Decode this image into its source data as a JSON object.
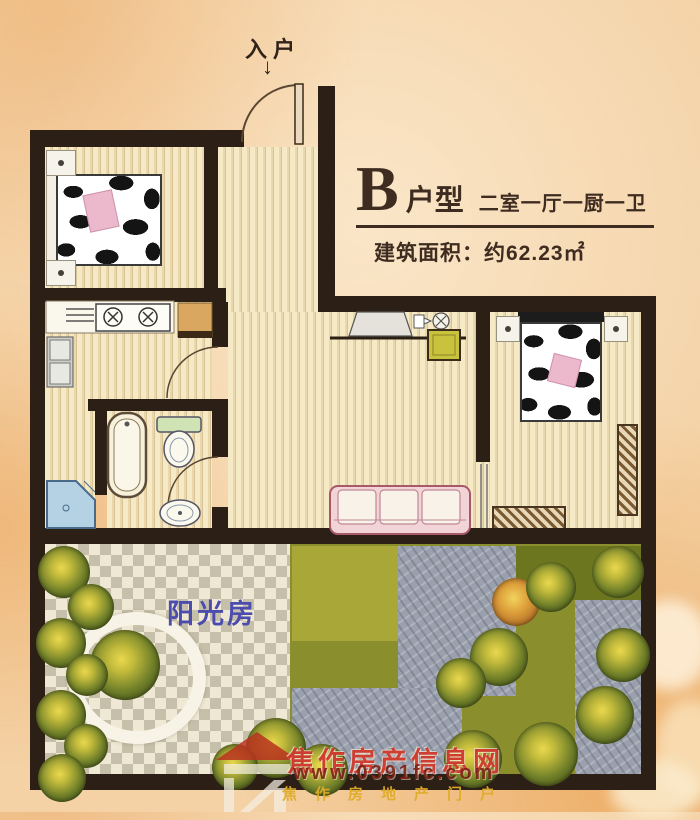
{
  "header": {
    "type_letter": "B",
    "type_suffix": "户型",
    "layout_desc": "二室一厅一厨一卫",
    "area_label": "建筑面积：",
    "area_value": "约62.23㎡"
  },
  "plan": {
    "entrance_label": "入户",
    "entrance_arrow": "↓",
    "sunroom_label": "阳光房"
  },
  "watermark": {
    "site_name": "焦作房产信息网",
    "site_url": "www.0391fc.com",
    "tagline": "焦作房地产门户"
  },
  "fixtures": [
    "double-bed",
    "double-bed",
    "sofa",
    "tv-stand",
    "stove",
    "range-hood",
    "refrigerator",
    "cabinet",
    "bathtub",
    "toilet",
    "washbasin",
    "corner-shower",
    "bench",
    "radiator",
    "round-planter",
    "trees",
    "entrance-door",
    "interior-doors"
  ],
  "colors": {
    "wall": "#2c1f16",
    "background": "#f4d2a6",
    "title_text": "#3f2c20",
    "sunroom_text": "#4c4cae",
    "watermark_red": "#cb281c",
    "watermark_gold": "#deac28",
    "lawn": "#8b8e2c",
    "tile_gray": "#c6bfa9"
  }
}
